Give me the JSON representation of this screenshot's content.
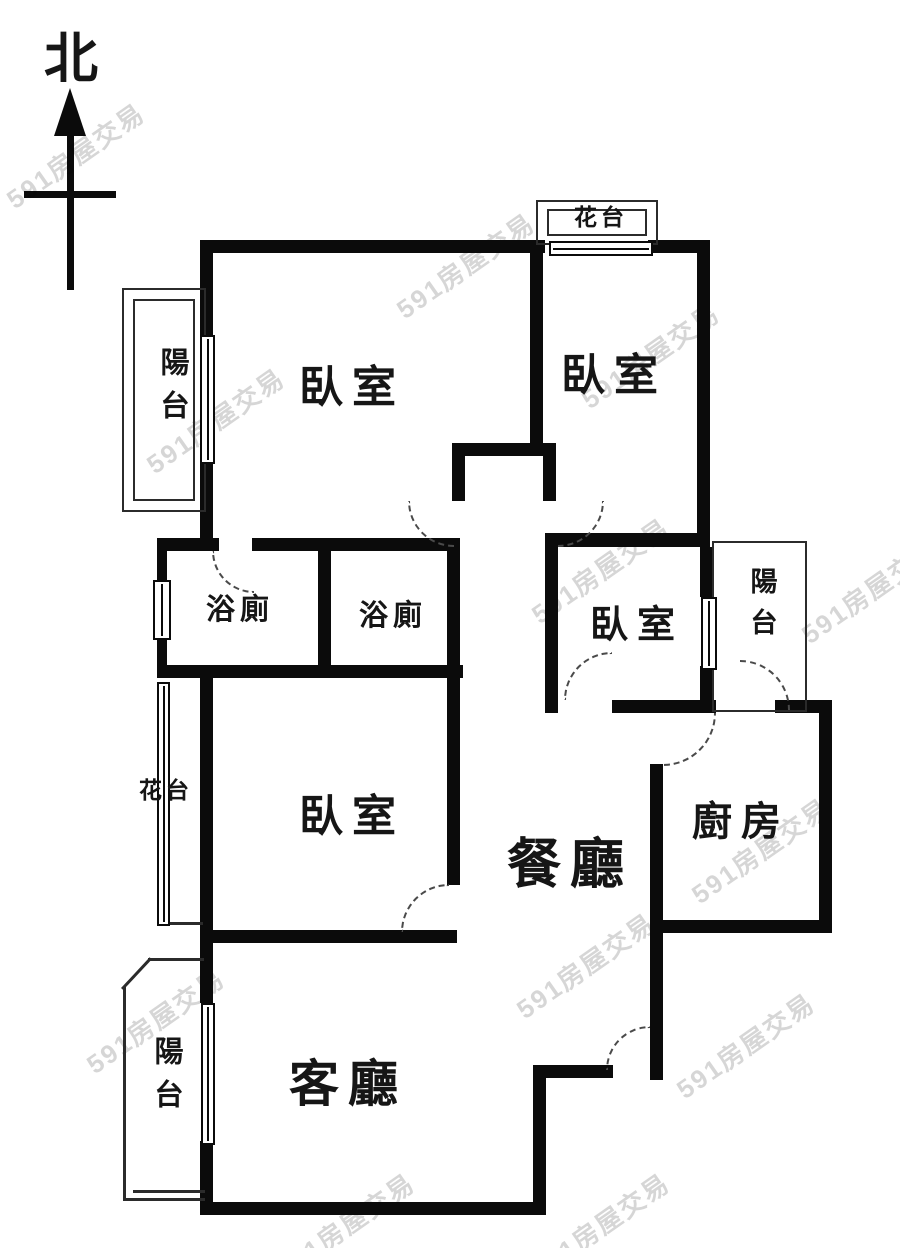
{
  "meta": {
    "width": 900,
    "height": 1248,
    "type": "apartment-floor-plan"
  },
  "compass": {
    "label": "北"
  },
  "labels": {
    "bedroom_nw": "臥室",
    "bedroom_ne": "臥室",
    "bedroom_e": "臥室",
    "bedroom_sw": "臥室",
    "bath_1": "浴廁",
    "bath_2": "浴廁",
    "dining": "餐廳",
    "kitchen": "廚房",
    "living": "客廳",
    "balcony_nw": "陽台",
    "balcony_e": "陽台",
    "balcony_sw": "陽台",
    "flower_n": "花台",
    "flower_w": "花台"
  },
  "watermark": {
    "text": "591房屋交易"
  },
  "colors": {
    "wall": "#0b0b0b",
    "thin_line": "#2b2b2b",
    "dash": "#4a4a4a",
    "background": "#ffffff",
    "watermark": "rgba(0,0,0,0.16)",
    "text": "#161616"
  }
}
